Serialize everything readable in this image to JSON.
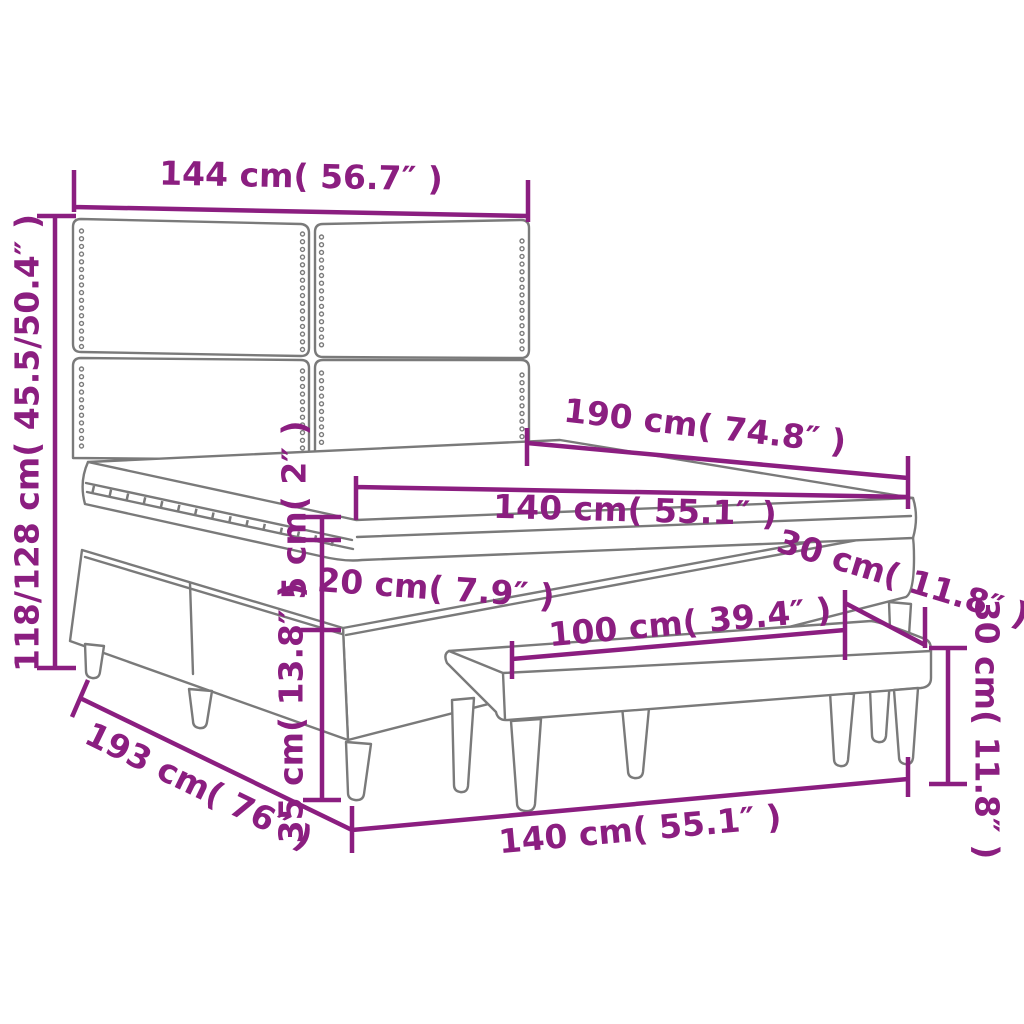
{
  "diagram": {
    "type": "product-dimension-diagram",
    "subject": "box spring bed with headboard and bench",
    "colors": {
      "dimension": "#8B1E80",
      "outline": "#7A7A7A",
      "background": "#FFFFFF"
    },
    "dimensions": {
      "headboard_width": "144 cm( 56.7″ )",
      "total_height": "118/128 cm( 45.5/50.4″ )",
      "bed_length": "190 cm( 74.8″ )",
      "mattress_width": "140 cm( 55.1″ )",
      "topper_height": "5 cm( 2″ )",
      "mattress_height": "20 cm( 7.9″ )",
      "base_height": "35 cm( 13.8″ )",
      "frame_length": "193 cm( 76″ )",
      "frame_width": "140 cm( 55.1″ )",
      "bench_width": "100 cm( 39.4″ )",
      "bench_depth": "30 cm( 11.8″ )",
      "bench_height": "30 cm( 11.8″ )"
    }
  }
}
